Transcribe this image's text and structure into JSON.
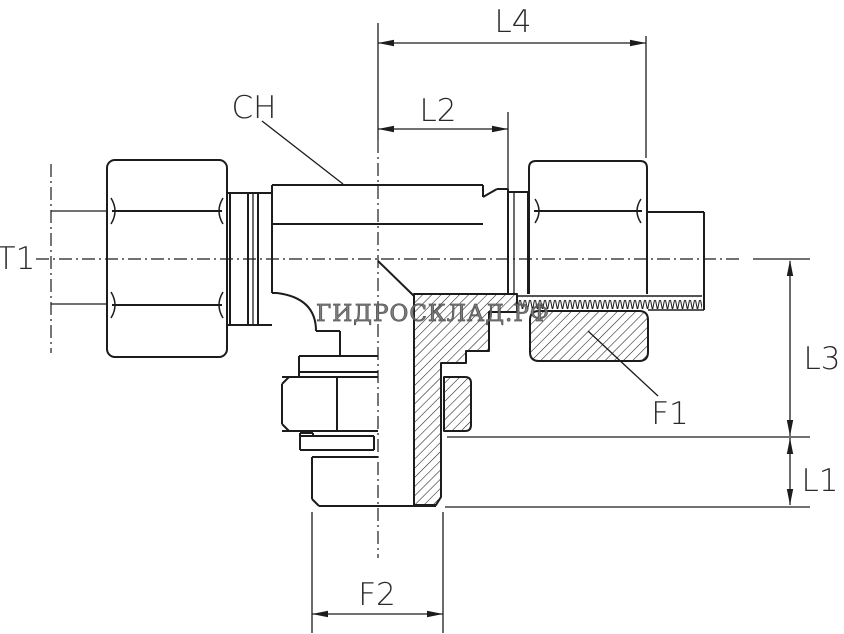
{
  "drawing": {
    "background": "#ffffff",
    "line_color": "#1c1c1c",
    "label_color": "#2a2a2a",
    "watermark": {
      "text": "ГИДРОСКЛАД.РФ",
      "color": "#757575"
    },
    "labels": {
      "l4": "L4",
      "l2": "L2",
      "ch": "CH",
      "t1": "T1",
      "l3": "L3",
      "l1": "L1",
      "f1": "F1",
      "f2": "F2"
    }
  }
}
